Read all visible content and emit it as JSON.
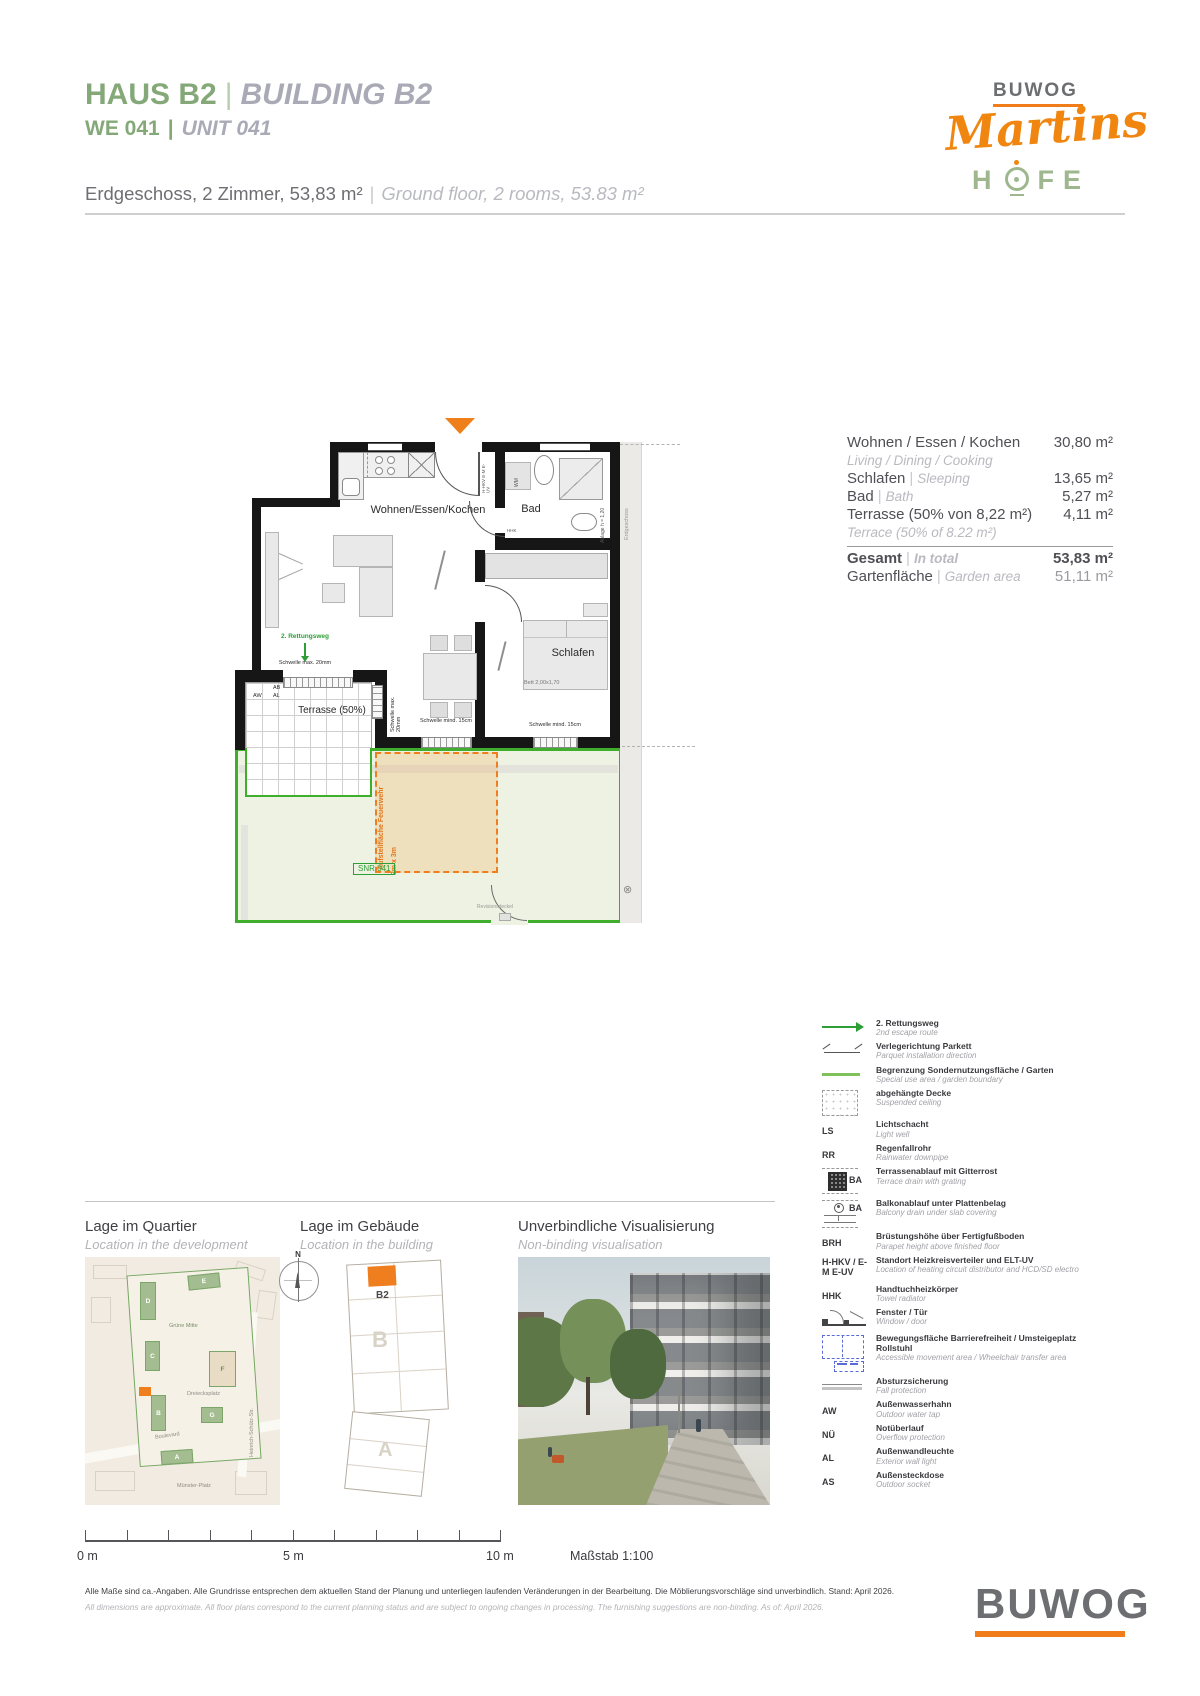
{
  "ui": {
    "pipe": "|"
  },
  "header": {
    "title_de": "HAUS B2",
    "title_en": "BUILDING B2",
    "unit_de": "WE 041",
    "unit_en": "UNIT 041",
    "info_de": "Erdgeschoss, 2 Zimmer, 53,83 m²",
    "info_en": "Ground floor, 2 rooms, 53.83 m²"
  },
  "brand": {
    "name": "BUWOG",
    "project_script": "Martins",
    "hofe_h": "H",
    "hofe_fe": "FE"
  },
  "areas": {
    "rows": [
      {
        "de": "Wohnen / Essen / Kochen",
        "en": "Living / Dining / Cooking",
        "value": "30,80 m²"
      },
      {
        "de": "Schlafen",
        "en": "Sleeping",
        "value": "13,65 m²"
      },
      {
        "de": "Bad",
        "en": "Bath",
        "value": "5,27 m²"
      },
      {
        "de": "Terrasse (50% von 8,22 m²)",
        "en": "Terrace (50% of 8.22 m²)",
        "value": "4,11 m²"
      }
    ],
    "total": {
      "de": "Gesamt",
      "en": "In total",
      "value": "53,83 m²"
    },
    "garden": {
      "de": "Gartenfläche",
      "en": "Garden area",
      "value": "51,11 m²"
    }
  },
  "plan": {
    "labels": {
      "living": "Wohnen/Essen/Kochen",
      "bath": "Bad",
      "sleep": "Schlafen",
      "terrace": "Terrasse (50%)",
      "escape": "2. Rettungsweg",
      "threshold_max": "Schwelle max. 20mm",
      "threshold_max_v": "Schwelle max. 20mm",
      "threshold_min1": "Schwelle mind. 15cm",
      "threshold_min2": "Schwelle mind. 15cm",
      "bed": "Bett 2,00x1,70",
      "fire1": "Aufstellfläche Feuerwehr",
      "fire2": "3m x 3m",
      "snr": "SNR 041",
      "revision": "Revisionsdeckel",
      "wm": "WM",
      "hhk": "HHK",
      "shelf": "Ablage h = 1,20",
      "hkv": "H-HKV E-M E-UV",
      "aw": "AW",
      "ab": "AB",
      "al": "AL",
      "side": "Erdgeschoss",
      "cross": "⊗"
    }
  },
  "legend": {
    "items": [
      {
        "de": "2. Rettungsweg",
        "en": "2nd escape route"
      },
      {
        "de": "Verlegerichtung Parkett",
        "en": "Parquet installation direction"
      },
      {
        "de": "Begrenzung Sondernutzungsfläche / Garten",
        "en": "Special use area / garden boundary"
      },
      {
        "de": "abgehängte Decke",
        "en": "Suspended ceiling"
      },
      {
        "abbr": "LS",
        "de": "Lichtschacht",
        "en": "Light well"
      },
      {
        "abbr": "RR",
        "de": "Regenfallrohr",
        "en": "Rainwater downpipe"
      },
      {
        "abbr": "BA",
        "de": "Terrassenablauf mit Gitterrost",
        "en": "Terrace drain with grating"
      },
      {
        "abbr": "BA",
        "de": "Balkonablauf unter Plattenbelag",
        "en": "Balcony drain under slab covering"
      },
      {
        "abbr": "BRH",
        "de": "Brüstungshöhe über Fertigfußboden",
        "en": "Parapet height above finished floor"
      },
      {
        "abbr": "H-HKV / E-M E-UV",
        "de": "Standort Heizkreisverteiler und ELT-UV",
        "en": "Location of heating circuit distributor and HCD/SD electro"
      },
      {
        "abbr": "HHK",
        "de": "Handtuchheizkörper",
        "en": "Towel radiator"
      },
      {
        "de": "Fenster / Tür",
        "en": "Window / door"
      },
      {
        "de": "Bewegungsfläche Barrierefreiheit / Umsteigeplatz Rollstuhl",
        "en": "Accessible movement area / Wheelchair transfer area"
      },
      {
        "de": "Absturzsicherung",
        "en": "Fall protection"
      },
      {
        "abbr": "AW",
        "de": "Außenwasserhahn",
        "en": "Outdoor water tap"
      },
      {
        "abbr": "NÜ",
        "de": "Notüberlauf",
        "en": "Overflow protection"
      },
      {
        "abbr": "AL",
        "de": "Außenwandleuchte",
        "en": "Exterior wall light"
      },
      {
        "abbr": "AS",
        "de": "Außensteckdose",
        "en": "Outdoor socket"
      }
    ]
  },
  "panels": {
    "quartier_de": "Lage im Quartier",
    "quartier_en": "Location in the development",
    "gebaeude_de": "Lage im Gebäude",
    "gebaeude_en": "Location in the building",
    "visual_de": "Unverbindliche Visualisierung",
    "visual_en": "Non-binding visualisation"
  },
  "map": {
    "compass": "N",
    "blocks": {
      "a": "A",
      "b": "B",
      "c": "C",
      "d": "D",
      "e": "E",
      "f": "F",
      "g": "G"
    },
    "labels": {
      "gruene_mitte": "Grüne Mitte",
      "platz": "Dreiecksplatz",
      "boulevard": "Boulevard",
      "street": "Heinrich-Schütz-Str.",
      "platz2": "Münster-Platz"
    }
  },
  "building": {
    "unit": "B2",
    "letter_b": "B",
    "letter_a": "A"
  },
  "scalebar": {
    "t0": "0 m",
    "t5": "5 m",
    "t10": "10 m",
    "scale": "Maßstab 1:100"
  },
  "footer": {
    "disclaimer_de": "Alle Maße sind ca.-Angaben. Alle Grundrisse entsprechen dem aktuellen Stand der Planung und unterliegen laufenden Veränderungen in der Bearbeitung. Die Möblierungsvorschläge sind unverbindlich. Stand: April 2026.",
    "disclaimer_en": "All dimensions are approximate. All floor plans correspond to the current planning status and are subject to ongoing changes in processing. The furnishing suggestions are non-binding. As of: April 2026.",
    "brand": "BUWOG"
  },
  "colors": {
    "green": "#84a878",
    "orange": "#f07d1a",
    "boundary_green": "#3fae2d",
    "gray_italic": "#a9aab6"
  }
}
